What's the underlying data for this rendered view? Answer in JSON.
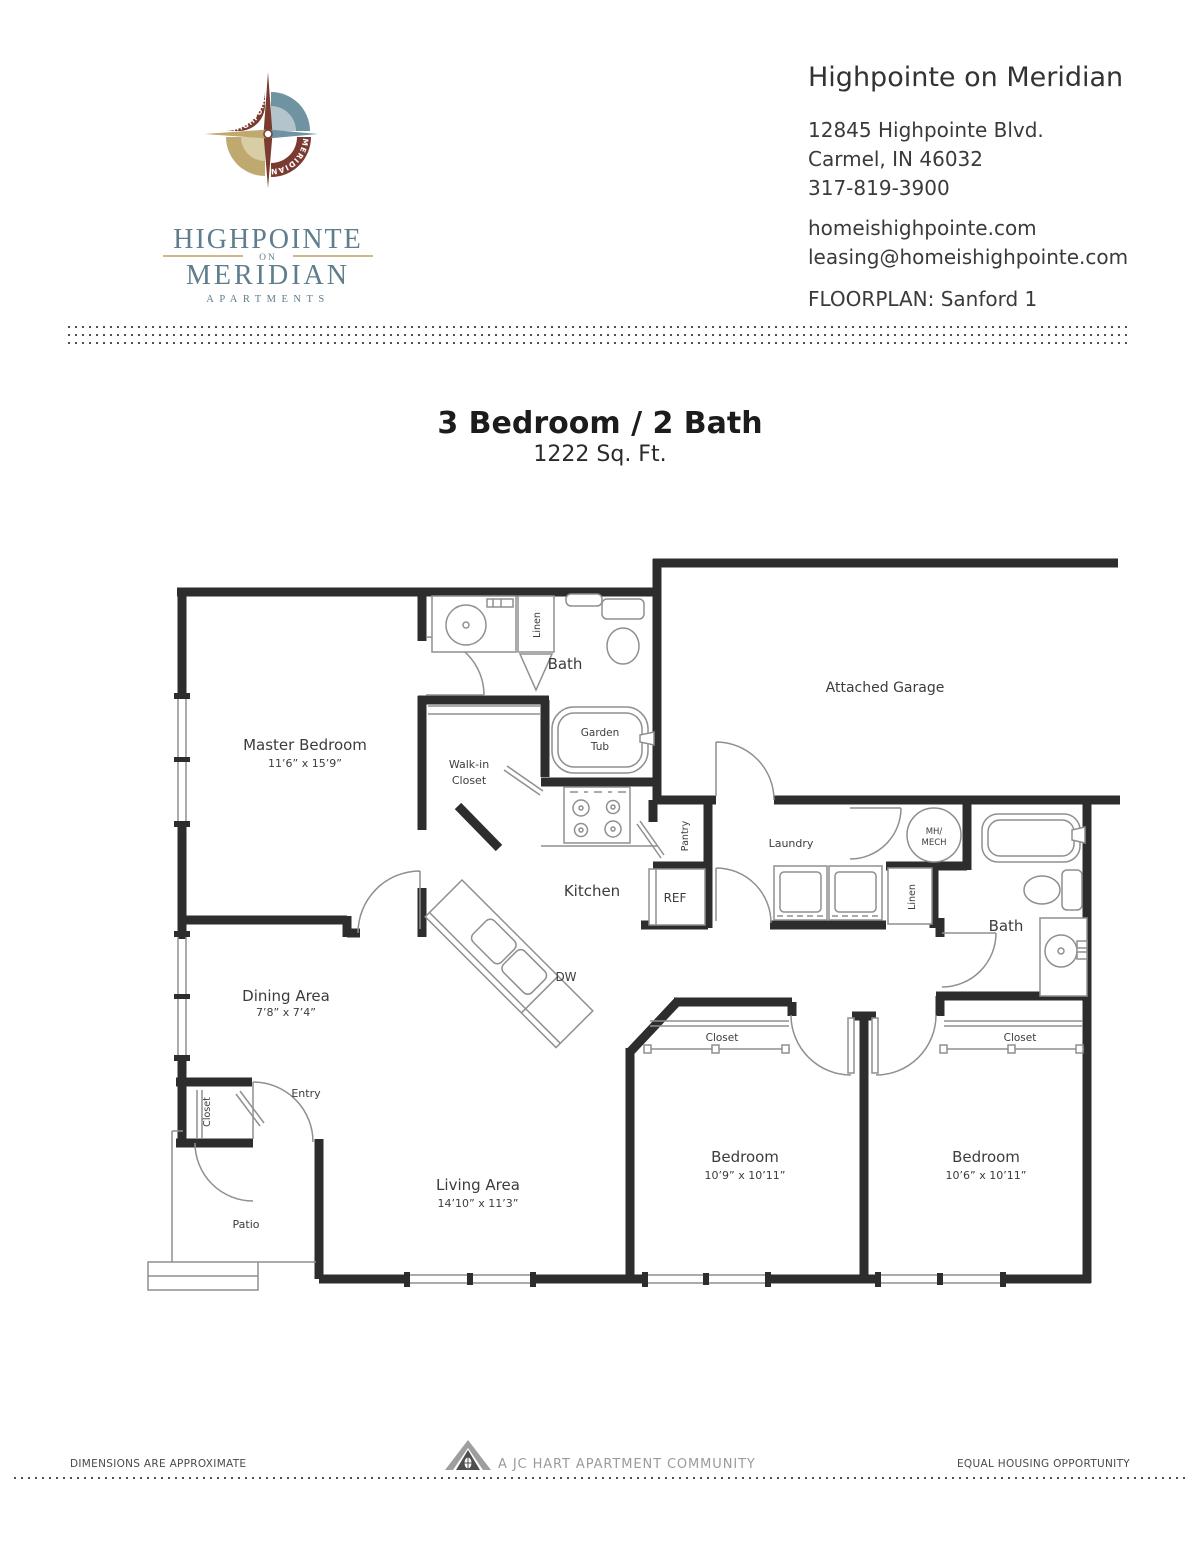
{
  "header": {
    "logo": {
      "compass_arc_top": "HIGHPOINTE",
      "compass_arc_bottom": "MERIDIAN",
      "wordmark_line1": "HIGHPOINTE",
      "wordmark_on": "ON",
      "wordmark_line2": "MERIDIAN",
      "wordmark_line3": "APARTMENTS"
    },
    "property_name": "Highpointe on Meridian",
    "address_line1": "12845 Highpointe Blvd.",
    "address_line2": "Carmel, IN 46032",
    "phone": "317-819-3900",
    "website": "homeishighpointe.com",
    "email": "leasing@homeishighpointe.com",
    "floorplan_label": "FLOORPLAN: Sanford 1"
  },
  "title": {
    "main": "3 Bedroom / 2 Bath",
    "sqft": "1222 Sq. Ft."
  },
  "floorplan": {
    "labels": {
      "bath_top": "Bath",
      "linen_top": "Linen",
      "garden_tub_1": "Garden",
      "garden_tub_2": "Tub",
      "master_bedroom": "Master Bedroom",
      "master_bedroom_dims": "11’6” x 15’9”",
      "walk_in_1": "Walk-in",
      "walk_in_2": "Closet",
      "attached_garage": "Attached Garage",
      "kitchen": "Kitchen",
      "pantry": "Pantry",
      "ref": "REF",
      "dw": "DW",
      "laundry": "Laundry",
      "mh_mech_1": "MH/",
      "mh_mech_2": "MECH",
      "linen_hall": "Linen",
      "bath_hall": "Bath",
      "dining_area": "Dining Area",
      "dining_area_dims": "7’8” x 7’4”",
      "entry": "Entry",
      "entry_closet": "Closet",
      "patio": "Patio",
      "living_area": "Living Area",
      "living_area_dims": "14’10” x 11’3”",
      "bedroom_left": "Bedroom",
      "bedroom_left_dims": "10’9” x 10’11”",
      "bedroom_right": "Bedroom",
      "bedroom_right_dims": "10’6” x 10’11”",
      "closet_left": "Closet",
      "closet_right": "Closet"
    }
  },
  "footer": {
    "left": "DIMENSIONS ARE APPROXIMATE",
    "center": "A JC HART APARTMENT COMMUNITY",
    "right": "EQUAL HOUSING OPPORTUNITY"
  },
  "colors": {
    "wall": "#2d2d2d",
    "fixture_line": "#8f8f8f",
    "label_text": "#3c3c3c",
    "logo_teal": "#6f93a0",
    "logo_teal_light": "#b3c4cc",
    "logo_gold": "#c0a96e",
    "logo_gold_light": "#d9cda6",
    "logo_maroon": "#7a3a30",
    "wordmark_blue": "#5f7d8c",
    "wordmark_gold": "#c2a163",
    "wordmark_maroon": "#8a4a3f"
  }
}
